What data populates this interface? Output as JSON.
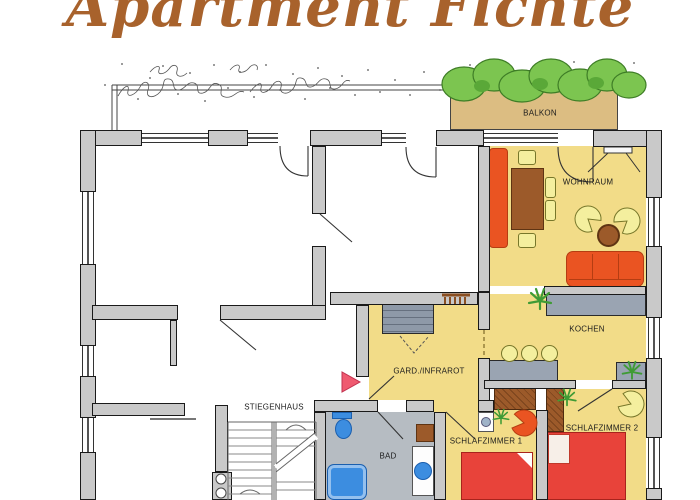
{
  "title": "Apartment Fichte",
  "rooms": {
    "balkon": "BALKON",
    "wohnraum": "WOHNRAUM",
    "kochen": "KOCHEN",
    "gard_infrarot": "GARD./INFRAROT",
    "stiegenhaus": "STIEGENHAUS",
    "bad": "BAD",
    "schlafzimmer1": "SCHLAFZIMMER 1",
    "schlafzimmer2": "SCHLAFZIMMER 2"
  },
  "colors": {
    "title": "#a8622c",
    "wall_fill": "#c9c9c9",
    "apartment_floor": "#f2dc88",
    "balcony_floor": "#dcbd82",
    "bath_floor": "#b6bcc2",
    "counter_gray": "#9aa4b2",
    "furniture_orange": "#ea5422",
    "bed_red": "#e8433a",
    "wood_brown": "#9c5a2a",
    "chair_yellow": "#f4ef9e",
    "fixture_blue": "#3c8de0",
    "plant_green": "#3f9b35",
    "bush_green": "#7cc550",
    "entrance_arrow": "#ef5a70"
  }
}
